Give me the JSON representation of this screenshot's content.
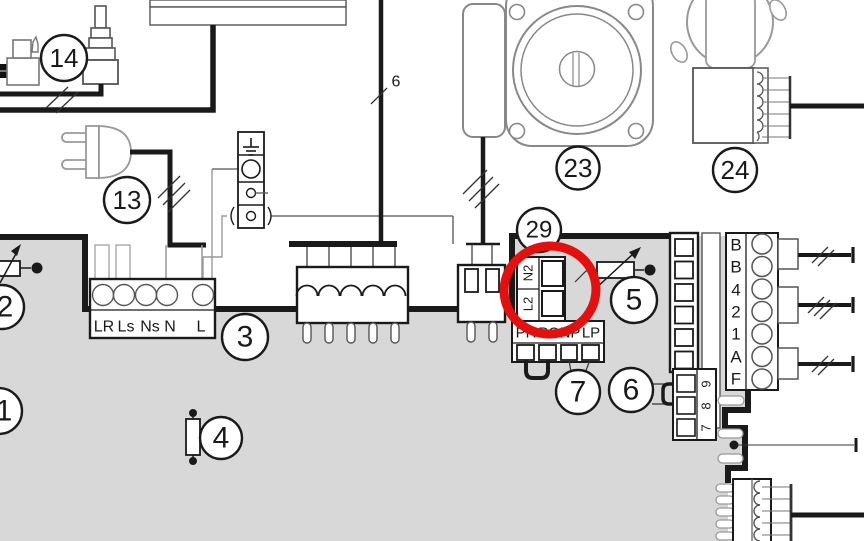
{
  "diagram": {
    "kind": "appliance wiring diagram",
    "background": "#ffffff",
    "board_fill": "#d8d8d8",
    "line_color": "#1a1a1a",
    "annotation_color": "#e41010"
  },
  "callouts": {
    "c1": "1",
    "c2": "2",
    "c3": "3",
    "c4": "4",
    "c5": "5",
    "c6": "6",
    "c7": "7",
    "c13": "13",
    "c14": "14",
    "c23": "23",
    "c24": "24",
    "c29": "29"
  },
  "wire_labels": {
    "w6": "6"
  },
  "terminal_block_3": {
    "labels": [
      "LR",
      "Ls",
      "Ns",
      "N",
      "L"
    ]
  },
  "connector_29": {
    "labels": [
      "N2",
      "L2"
    ]
  },
  "connector_7": {
    "labels": [
      "PR",
      "PO",
      "NP",
      "LP"
    ]
  },
  "terminal_strip_right": {
    "labels": [
      "B",
      "B",
      "4",
      "2",
      "1",
      "A",
      "F"
    ]
  },
  "connector_6": {
    "labels": [
      "9",
      "8",
      "7"
    ]
  },
  "annotation": {
    "shape": "hand-drawn-ellipse",
    "color": "#e41010"
  }
}
